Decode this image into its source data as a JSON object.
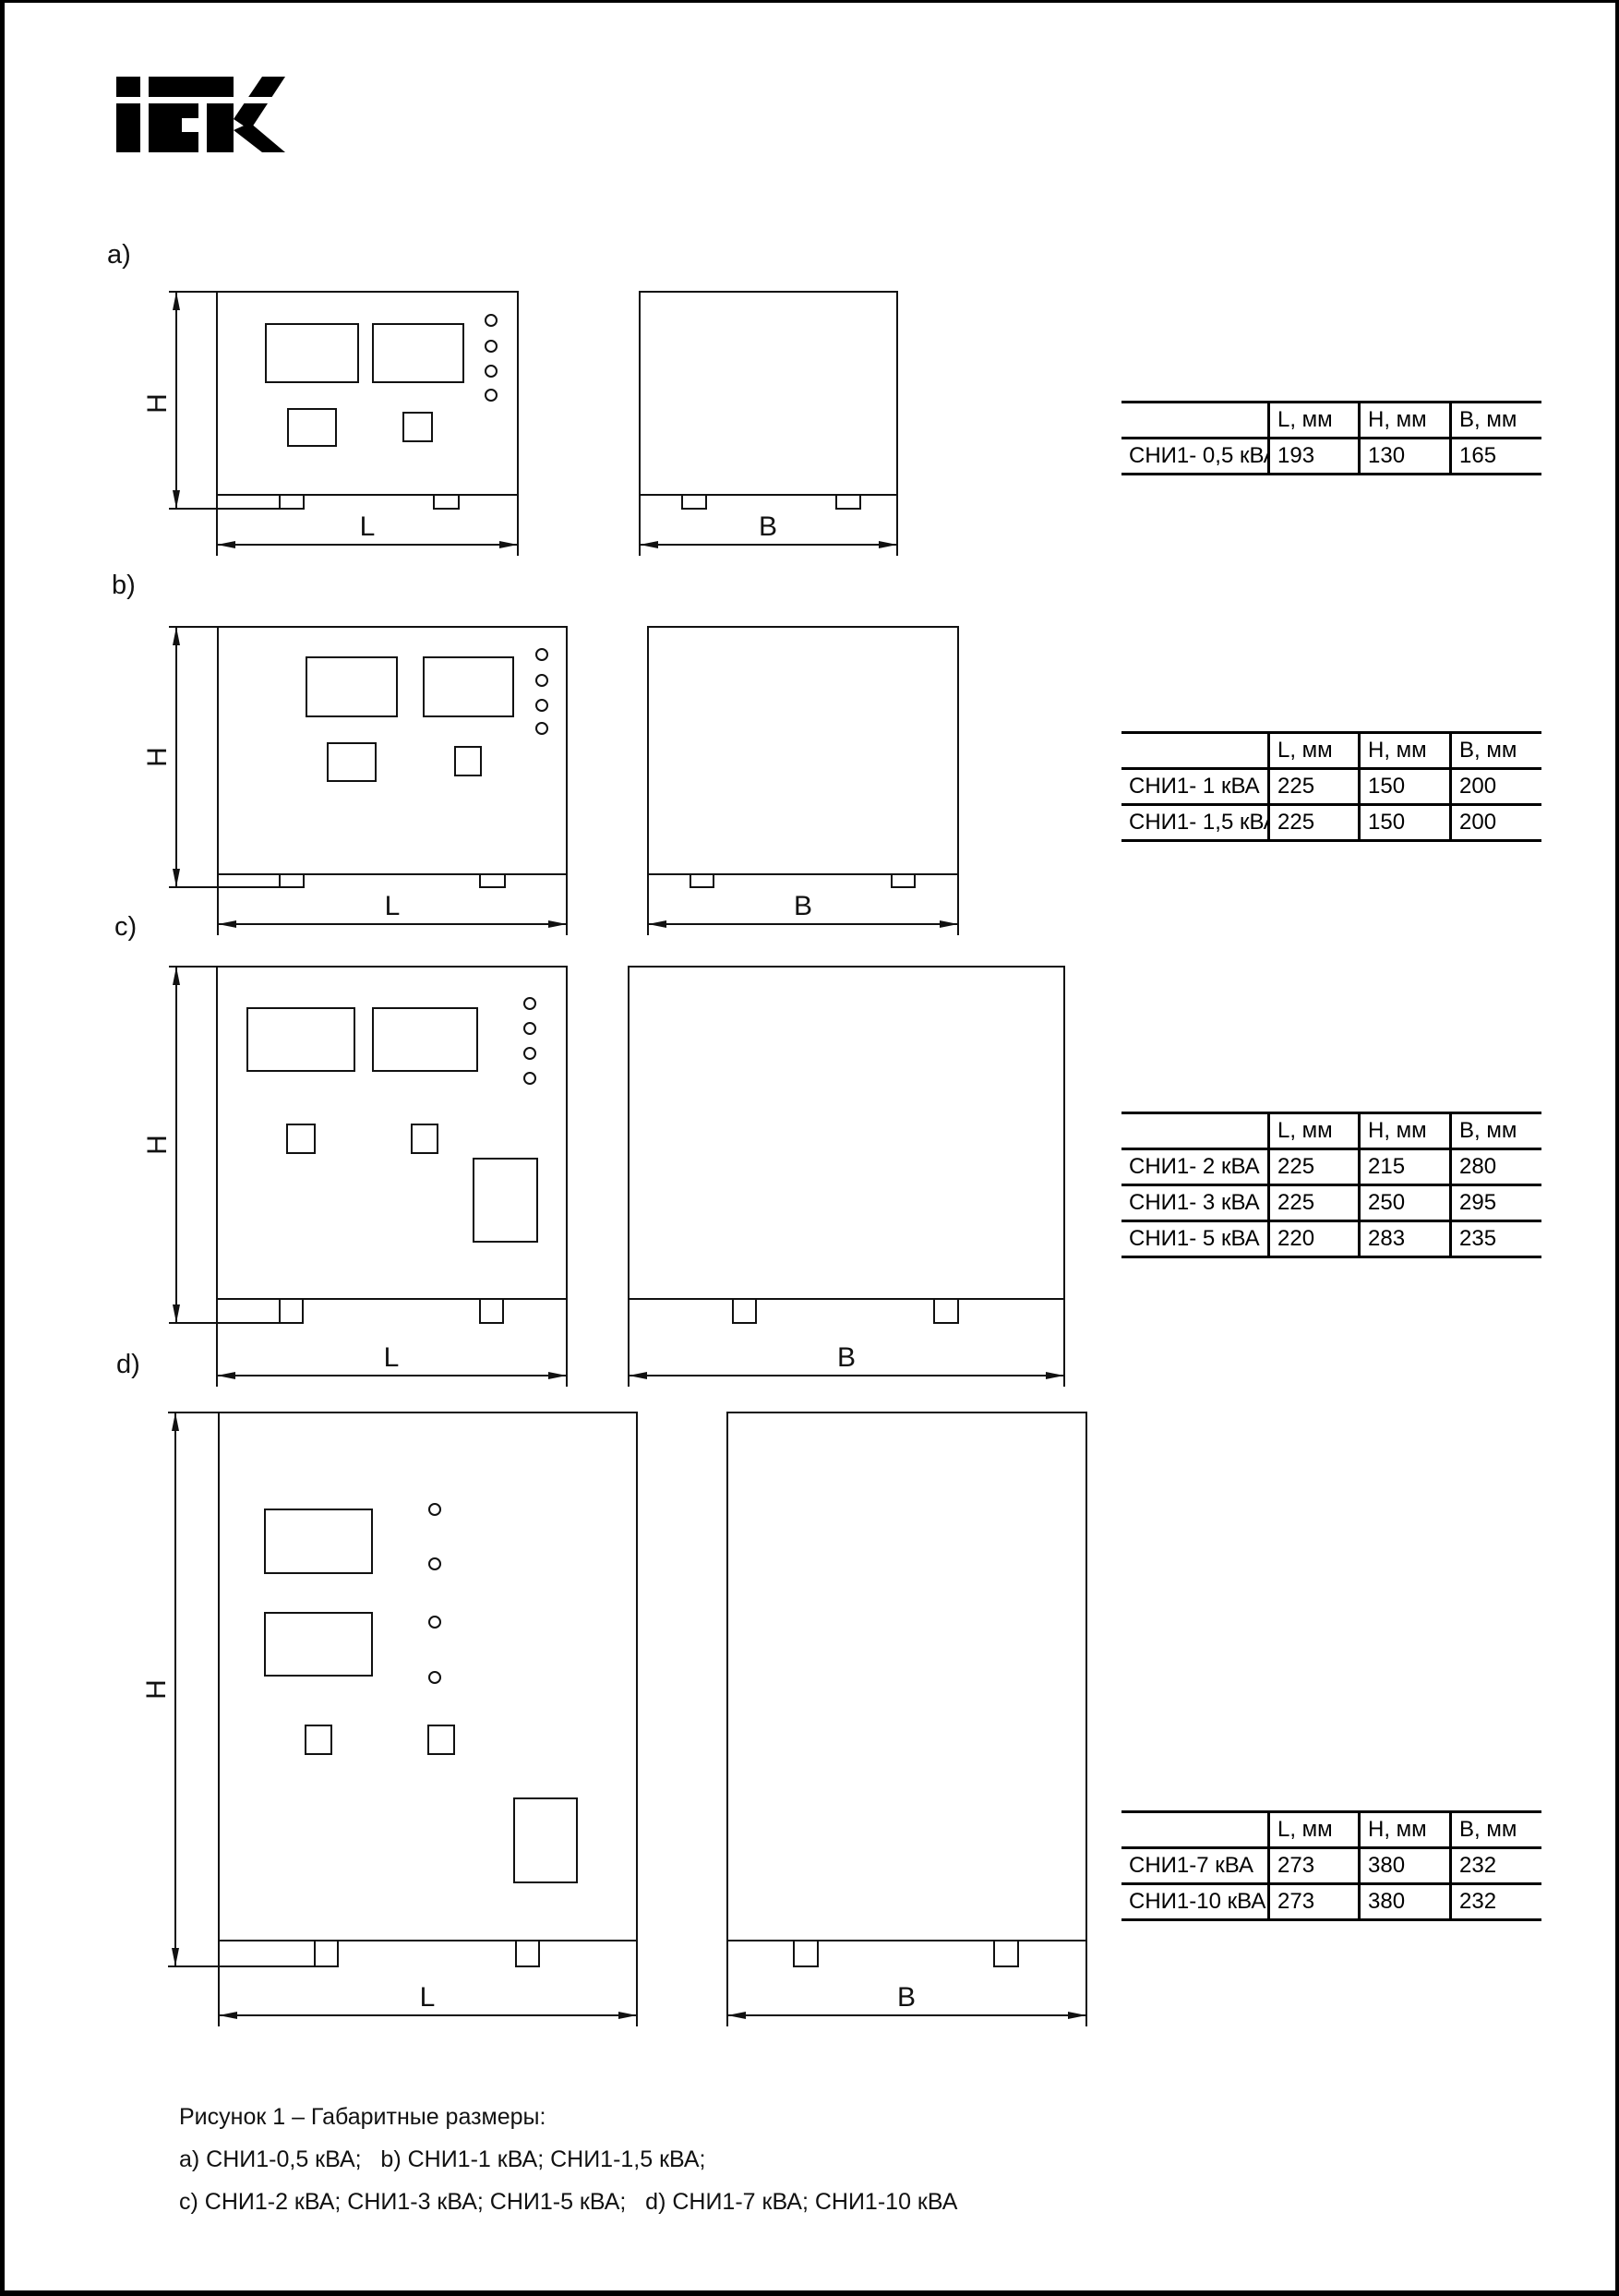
{
  "logo": {
    "brand": "IEK"
  },
  "sections": [
    {
      "label": "a)",
      "h": "H",
      "l": "L",
      "b": "B"
    },
    {
      "label": "b)",
      "h": "H",
      "l": "L",
      "b": "B"
    },
    {
      "label": "c)",
      "h": "H",
      "l": "L",
      "b": "B"
    },
    {
      "label": "d)",
      "h": "H",
      "l": "L",
      "b": "B"
    }
  ],
  "tables": [
    {
      "col_headers": [
        "L, мм",
        "H, мм",
        "B, мм"
      ],
      "rows": [
        {
          "model": "СНИ1- 0,5 кВА",
          "l": "193",
          "h": "130",
          "b": "165"
        }
      ]
    },
    {
      "col_headers": [
        "L, мм",
        "H, мм",
        "B, мм"
      ],
      "rows": [
        {
          "model": "СНИ1- 1 кВА",
          "l": "225",
          "h": "150",
          "b": "200"
        },
        {
          "model": "СНИ1- 1,5 кВА",
          "l": "225",
          "h": "150",
          "b": "200"
        }
      ]
    },
    {
      "col_headers": [
        "L, мм",
        "H, мм",
        "B, мм"
      ],
      "rows": [
        {
          "model": "СНИ1- 2 кВА",
          "l": "225",
          "h": "215",
          "b": "280"
        },
        {
          "model": "СНИ1- 3 кВА",
          "l": "225",
          "h": "250",
          "b": "295"
        },
        {
          "model": "СНИ1- 5 кВА",
          "l": "220",
          "h": "283",
          "b": "235"
        }
      ]
    },
    {
      "col_headers": [
        "L, мм",
        "H, мм",
        "B, мм"
      ],
      "rows": [
        {
          "model": "СНИ1-7 кВА",
          "l": "273",
          "h": "380",
          "b": "232"
        },
        {
          "model": "СНИ1-10 кВА",
          "l": "273",
          "h": "380",
          "b": "232"
        }
      ]
    }
  ],
  "caption": {
    "line1": "Рисунок 1 – Габаритные размеры:",
    "line2": "a) СНИ1-0,5 кВА;   b) СНИ1-1 кВА; СНИ1-1,5 кВА;",
    "line3": "c) СНИ1-2 кВА; СНИ1-3 кВА; СНИ1-5 кВА;   d) СНИ1-7 кВА; СНИ1-10 кВА"
  }
}
